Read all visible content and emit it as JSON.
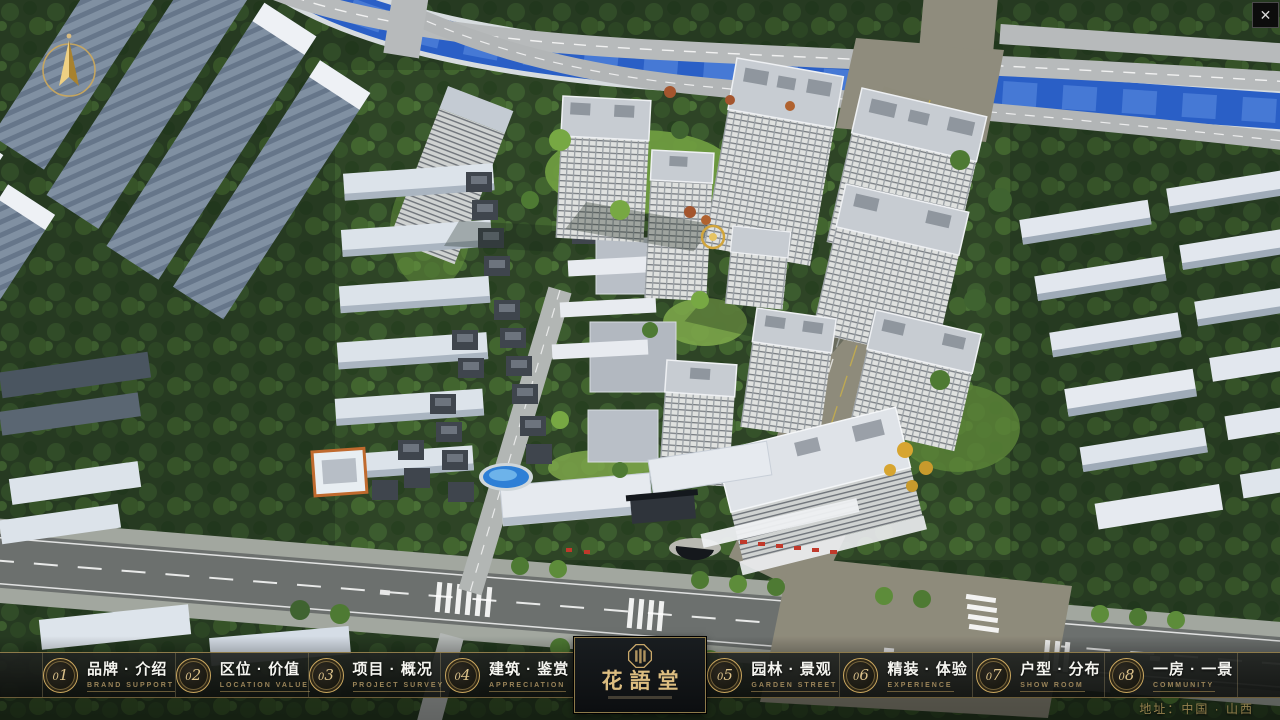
{
  "window": {
    "close_icon": "✕"
  },
  "nav": {
    "items": [
      {
        "num": "01",
        "zh": "品牌 · 介绍",
        "en": "BRAND SUPPORT"
      },
      {
        "num": "02",
        "zh": "区位 · 价值",
        "en": "LOCATION VALUE"
      },
      {
        "num": "03",
        "zh": "项目 · 概况",
        "en": "PROJECT SURVEY"
      },
      {
        "num": "04",
        "zh": "建筑 · 鉴赏",
        "en": "APPRECIATION"
      },
      {
        "num": "05",
        "zh": "园林 · 景观",
        "en": "GARDEN STREET"
      },
      {
        "num": "06",
        "zh": "精装 · 体验",
        "en": "EXPERIENCE"
      },
      {
        "num": "07",
        "zh": "户型 · 分布",
        "en": "SHOW ROOM"
      },
      {
        "num": "08",
        "zh": "一房 · 一景",
        "en": "COMMUNITY"
      }
    ],
    "logo": {
      "name": "花語堂"
    },
    "address": "地址：中国 · 山西"
  },
  "colors": {
    "accent_gold": "#c9a25e",
    "bar_background": "rgba(16,18,16,0.88)",
    "river_blue": "#2a5fc6",
    "tree_green": "#35522a",
    "road_asphalt": "#6c706e",
    "tower_roof": "#c7ccd2"
  }
}
